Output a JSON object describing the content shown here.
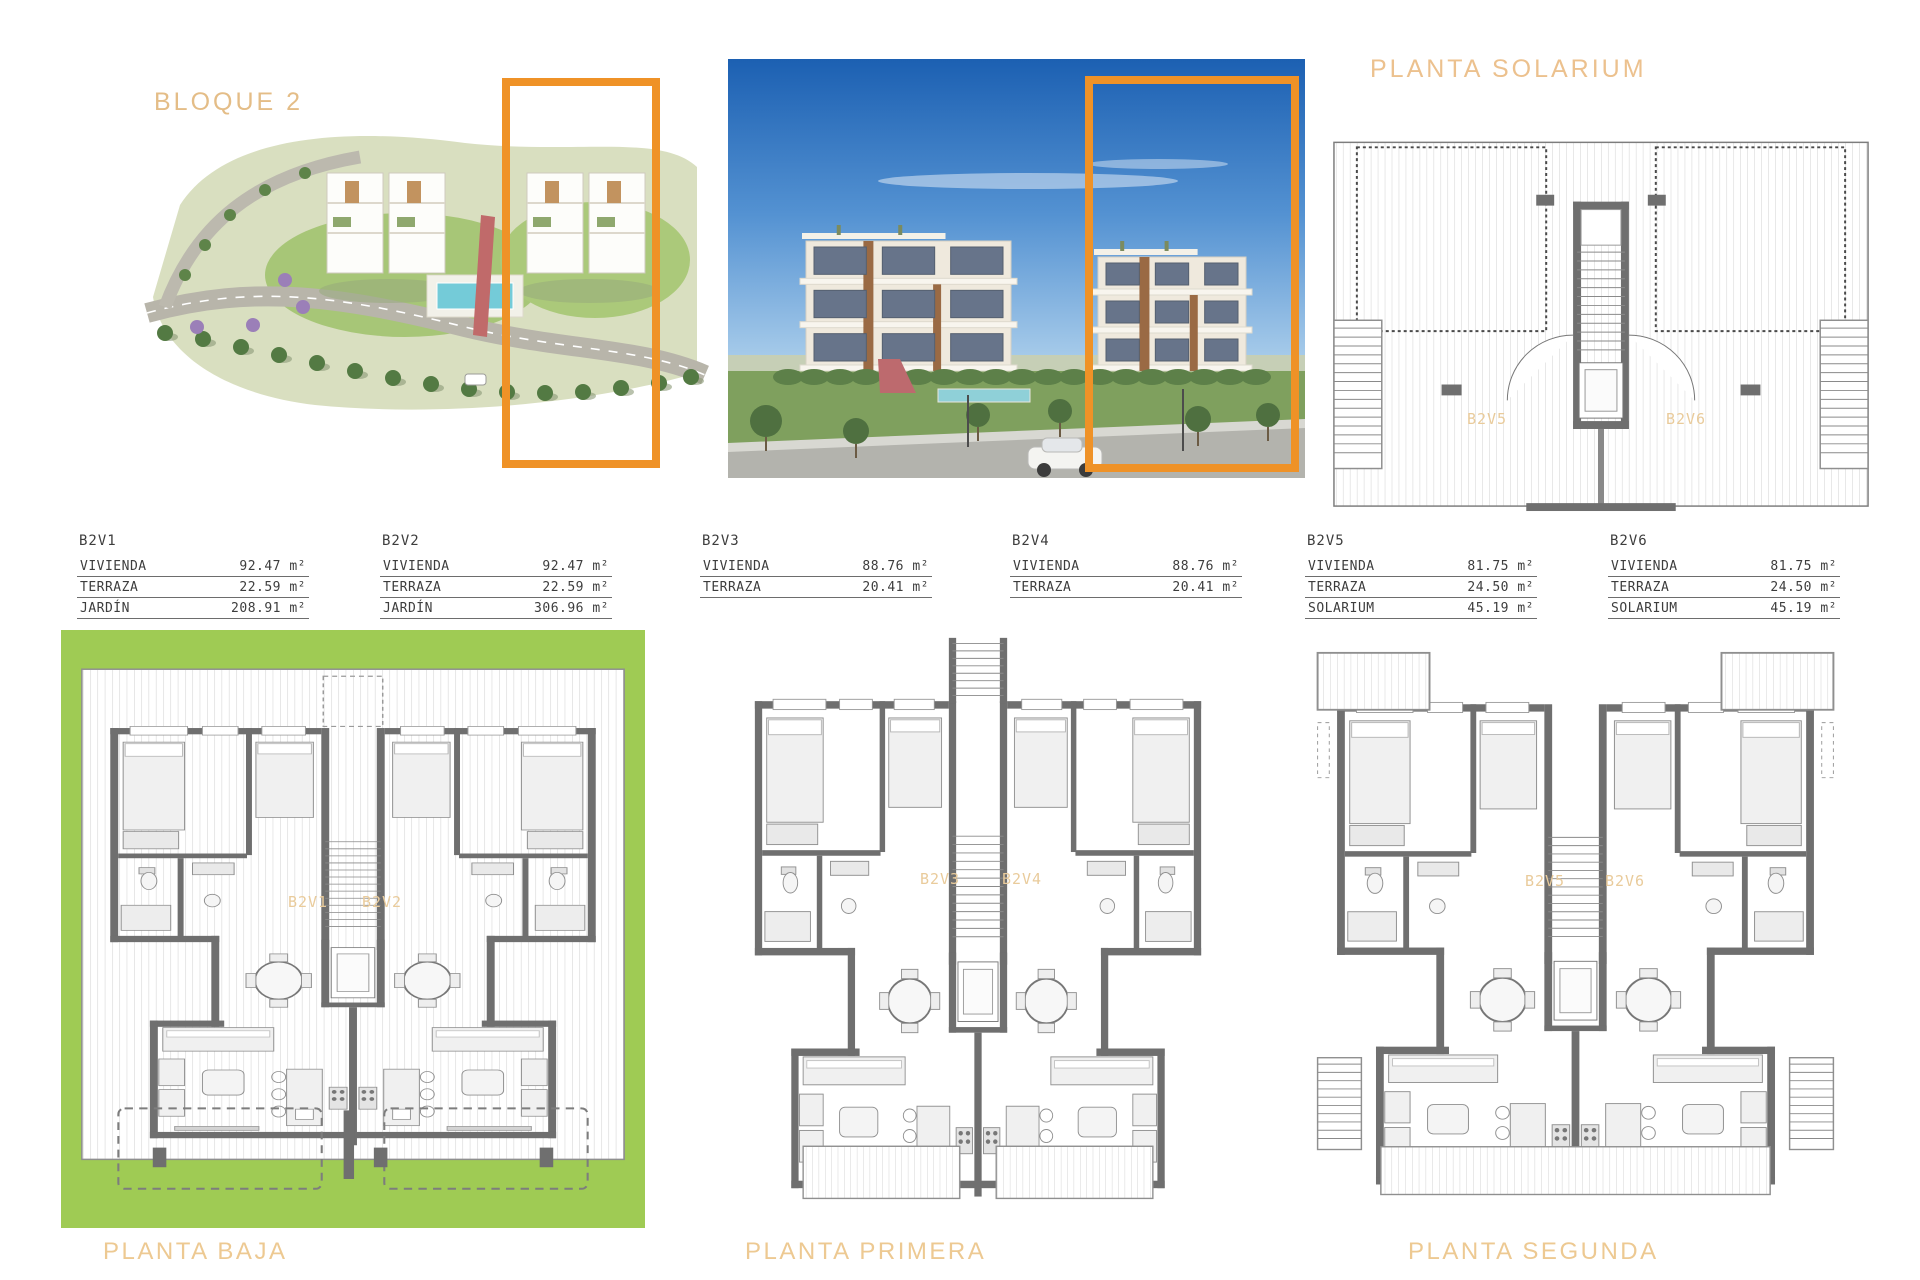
{
  "header": {
    "bloque_label": "BLOQUE 2",
    "solarium_plan_label": "PLANTA SOLARIUM"
  },
  "colors": {
    "highlight_orange": "#ef9227",
    "heading_orange": "#e4bd87",
    "caption_orange": "#edc992",
    "unit_label_orange": "#e9cb9b",
    "garden_green": "#9fcb54",
    "wall_gray": "#6f6f6f"
  },
  "tables": [
    {
      "id": "B2V1",
      "rows": [
        {
          "label": "VIVIENDA",
          "value": "92.47",
          "unit": "m²"
        },
        {
          "label": "TERRAZA",
          "value": "22.59",
          "unit": "m²"
        },
        {
          "label": "JARDÍN",
          "value": "208.91",
          "unit": "m²"
        }
      ]
    },
    {
      "id": "B2V2",
      "rows": [
        {
          "label": "VIVIENDA",
          "value": "92.47",
          "unit": "m²"
        },
        {
          "label": "TERRAZA",
          "value": "22.59",
          "unit": "m²"
        },
        {
          "label": "JARDÍN",
          "value": "306.96",
          "unit": "m²"
        }
      ]
    },
    {
      "id": "B2V3",
      "rows": [
        {
          "label": "VIVIENDA",
          "value": "88.76",
          "unit": "m²"
        },
        {
          "label": "TERRAZA",
          "value": "20.41",
          "unit": "m²"
        }
      ]
    },
    {
      "id": "B2V4",
      "rows": [
        {
          "label": "VIVIENDA",
          "value": "88.76",
          "unit": "m²"
        },
        {
          "label": "TERRAZA",
          "value": "20.41",
          "unit": "m²"
        }
      ]
    },
    {
      "id": "B2V5",
      "rows": [
        {
          "label": "VIVIENDA",
          "value": "81.75",
          "unit": "m²"
        },
        {
          "label": "TERRAZA",
          "value": "24.50",
          "unit": "m²"
        },
        {
          "label": "SOLARIUM",
          "value": "45.19",
          "unit": "m²"
        }
      ]
    },
    {
      "id": "B2V6",
      "rows": [
        {
          "label": "VIVIENDA",
          "value": "81.75",
          "unit": "m²"
        },
        {
          "label": "TERRAZA",
          "value": "24.50",
          "unit": "m²"
        },
        {
          "label": "SOLARIUM",
          "value": "45.19",
          "unit": "m²"
        }
      ]
    }
  ],
  "plans": {
    "baja": {
      "label": "PLANTA BAJA",
      "units": [
        "B2V1",
        "B2V2"
      ]
    },
    "primera": {
      "label": "PLANTA PRIMERA",
      "units": [
        "B2V3",
        "B2V4"
      ]
    },
    "segunda": {
      "label": "PLANTA SEGUNDA",
      "units": [
        "B2V5",
        "B2V6"
      ]
    },
    "solarium": {
      "units": [
        "B2V5",
        "B2V6"
      ]
    }
  }
}
